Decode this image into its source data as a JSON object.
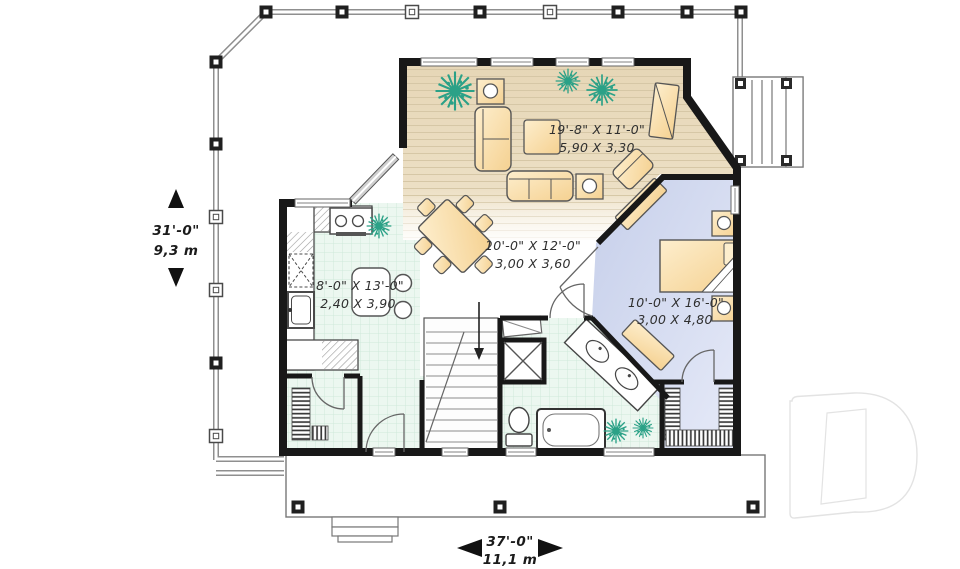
{
  "plan": {
    "type": "house-first-floor-plan",
    "rooms": {
      "living": {
        "label_imperial": "19'-8\" X 11'-0\"",
        "label_metric": "5,90 X 3,30"
      },
      "dining": {
        "label_imperial": "10'-0\" X 12'-0\"",
        "label_metric": "3,00 X 3,60"
      },
      "kitchen": {
        "label_imperial": "8'-0\" X 13'-0\"",
        "label_metric": "2,40 X 3,90"
      },
      "bedroom": {
        "label_imperial": "10'-0\" X 16'-0\"",
        "label_metric": "3,00 X 4,80"
      }
    },
    "overall_dimensions": {
      "depth": {
        "imperial": "31'-0\"",
        "metric": "9,3 m"
      },
      "width": {
        "imperial": "37'-0\"",
        "metric": "11,1 m"
      }
    }
  },
  "watermark": {
    "letter": "D"
  },
  "colors": {
    "wall": "#181818",
    "living_floor": "#e8dabc",
    "tile_floor": "#ecf7f0",
    "tile_line": "#cfe8da",
    "bedroom_floor": "#ccd4ec",
    "furniture": "#f7d79b",
    "furniture_light": "#fdeecd",
    "plant": "#2ba187",
    "railing": "#8f8f8f",
    "annotation_text": "#2f2f2f",
    "watermark_outline": "#e3e3e3"
  }
}
